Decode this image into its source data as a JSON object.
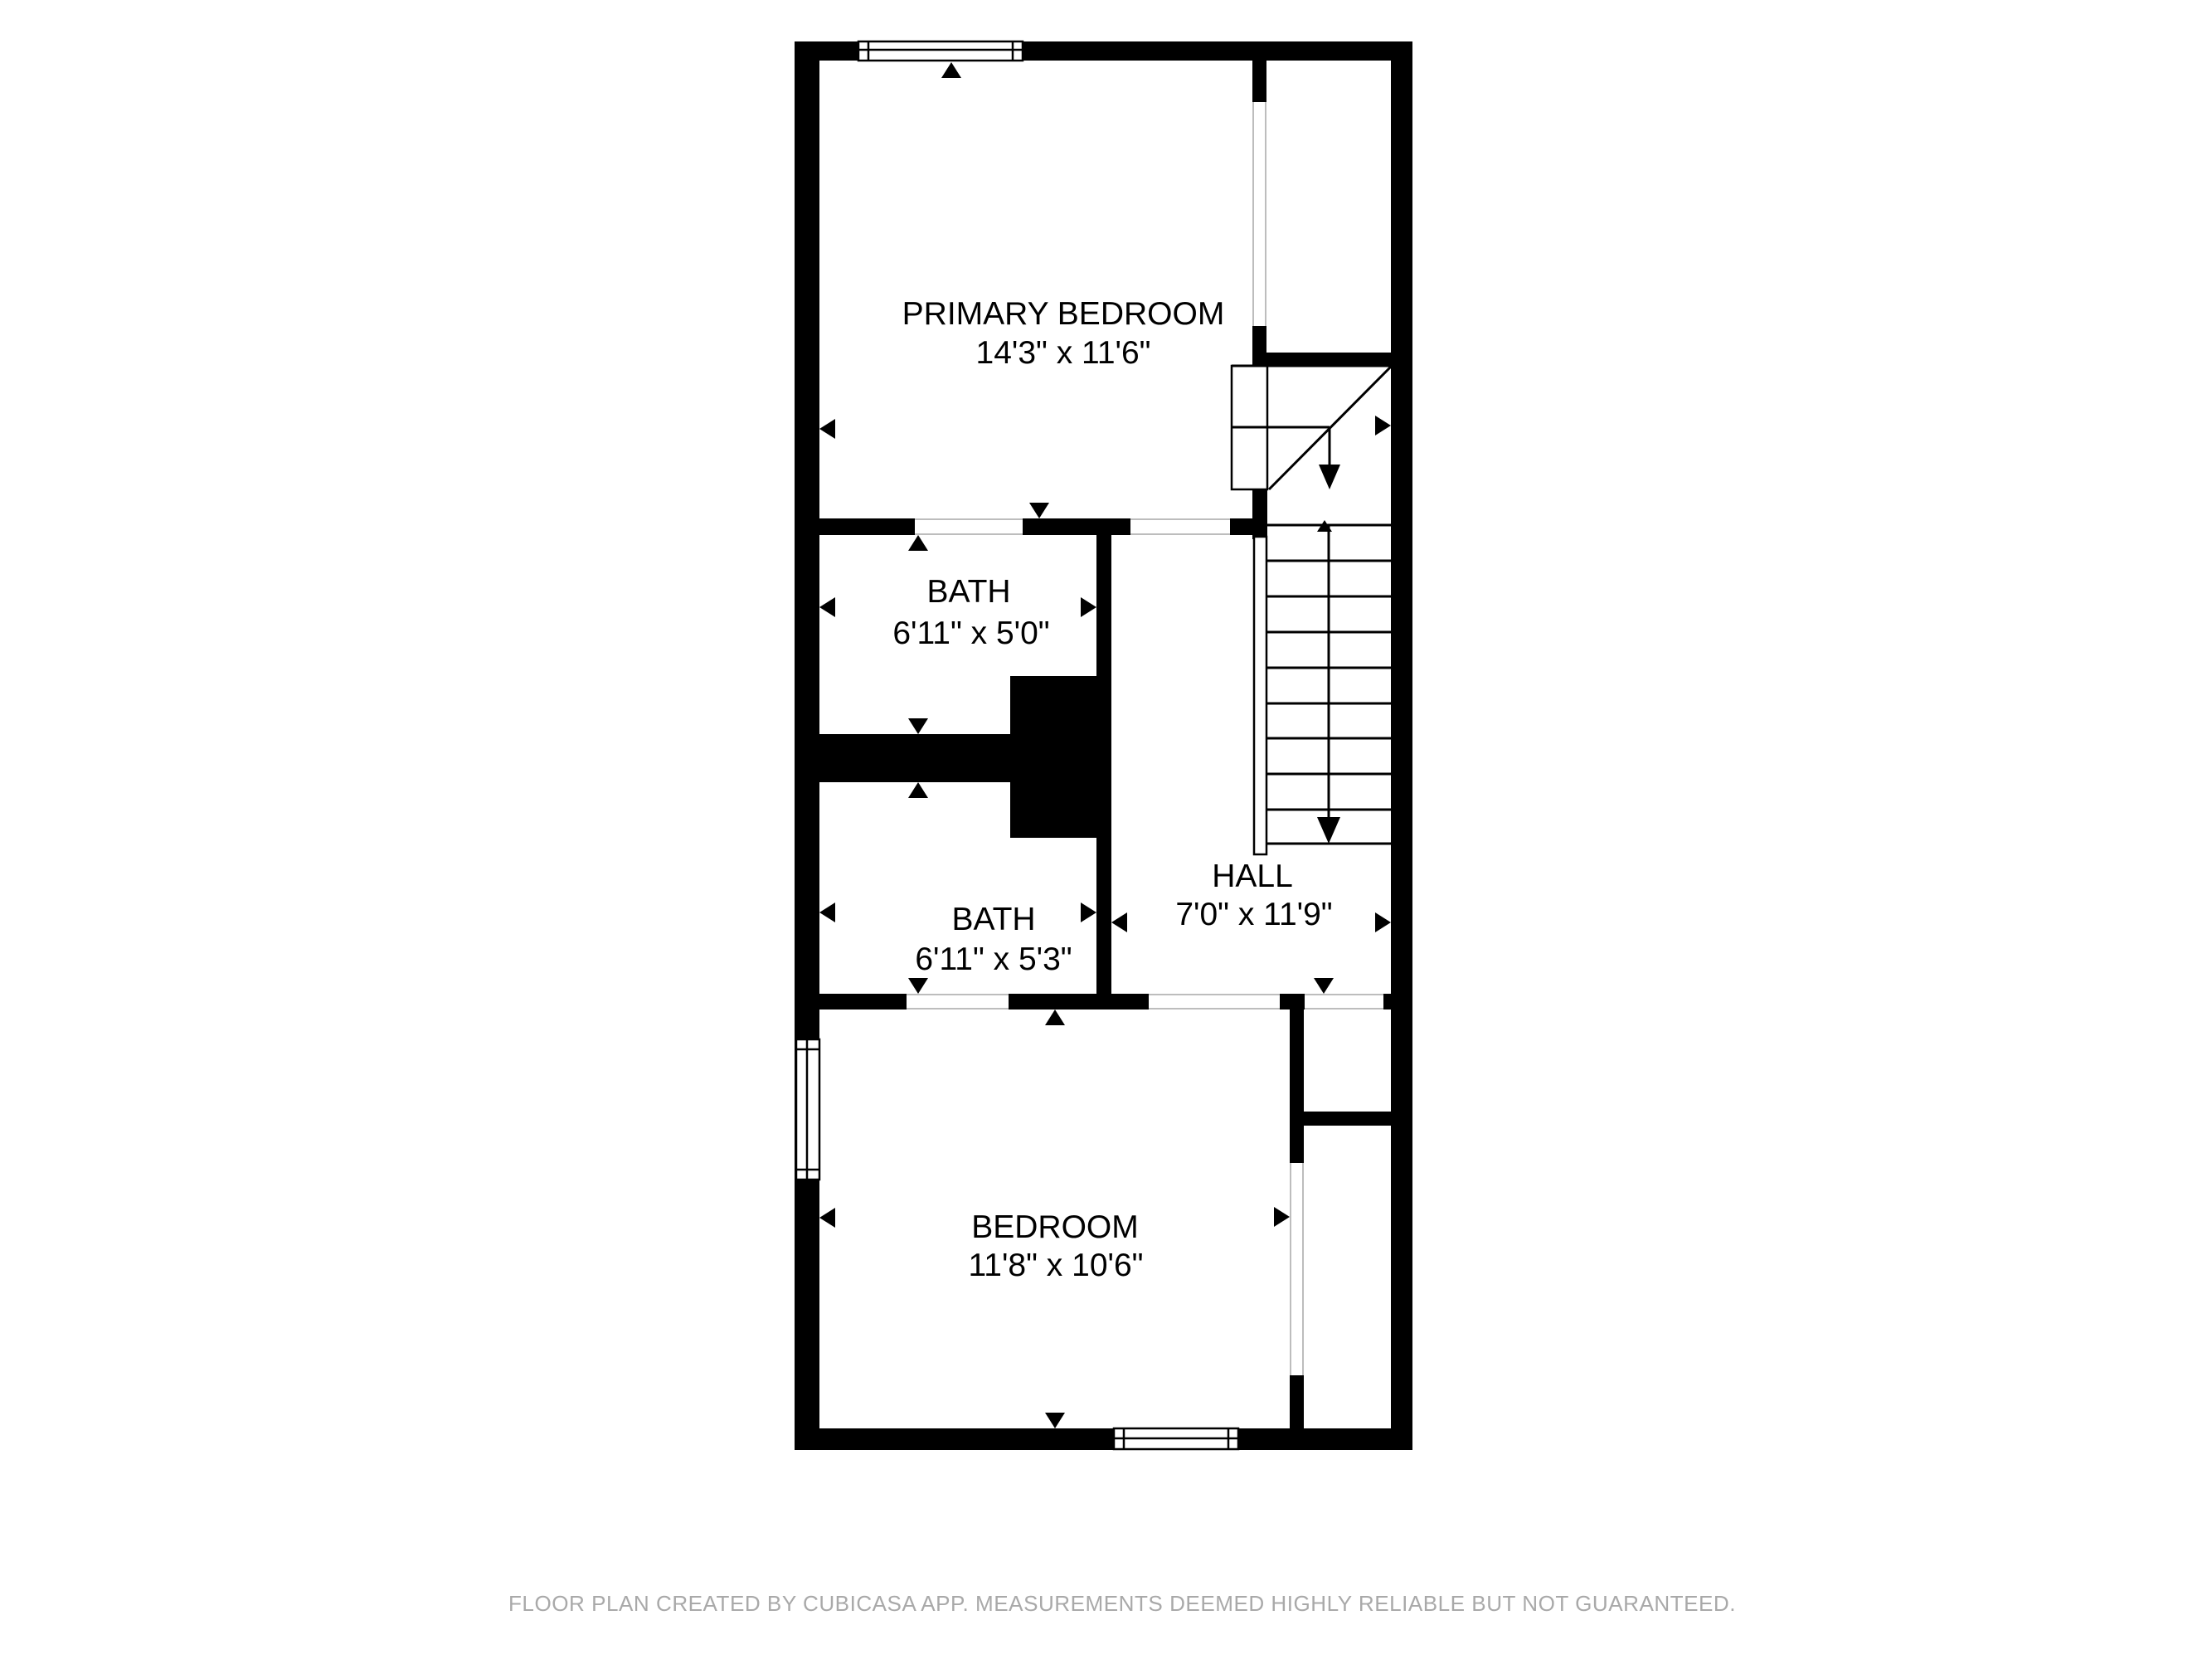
{
  "plan": {
    "colors": {
      "background": "#ffffff",
      "walls": "#000000",
      "opening_lines": "#bdbdbd",
      "footer_text": "#a9a9a9"
    },
    "rooms": [
      {
        "id": "primary-bedroom",
        "name": "PRIMARY BEDROOM",
        "dimensions": "14'3\" x 11'6\""
      },
      {
        "id": "bath-upper",
        "name": "BATH",
        "dimensions": "6'11\" x 5'0\""
      },
      {
        "id": "bath-lower",
        "name": "BATH",
        "dimensions": "6'11\" x 5'3\""
      },
      {
        "id": "hall",
        "name": "HALL",
        "dimensions": "7'0\" x 11'9\""
      },
      {
        "id": "bedroom",
        "name": "BEDROOM",
        "dimensions": "11'8\" x 10'6\""
      }
    ],
    "features": [
      "staircase-with-winder",
      "3-windows",
      "door-openings"
    ],
    "footer": {
      "text": "FLOOR PLAN CREATED BY CUBICASA APP. MEASUREMENTS DEEMED HIGHLY RELIABLE BUT NOT GUARANTEED."
    }
  }
}
